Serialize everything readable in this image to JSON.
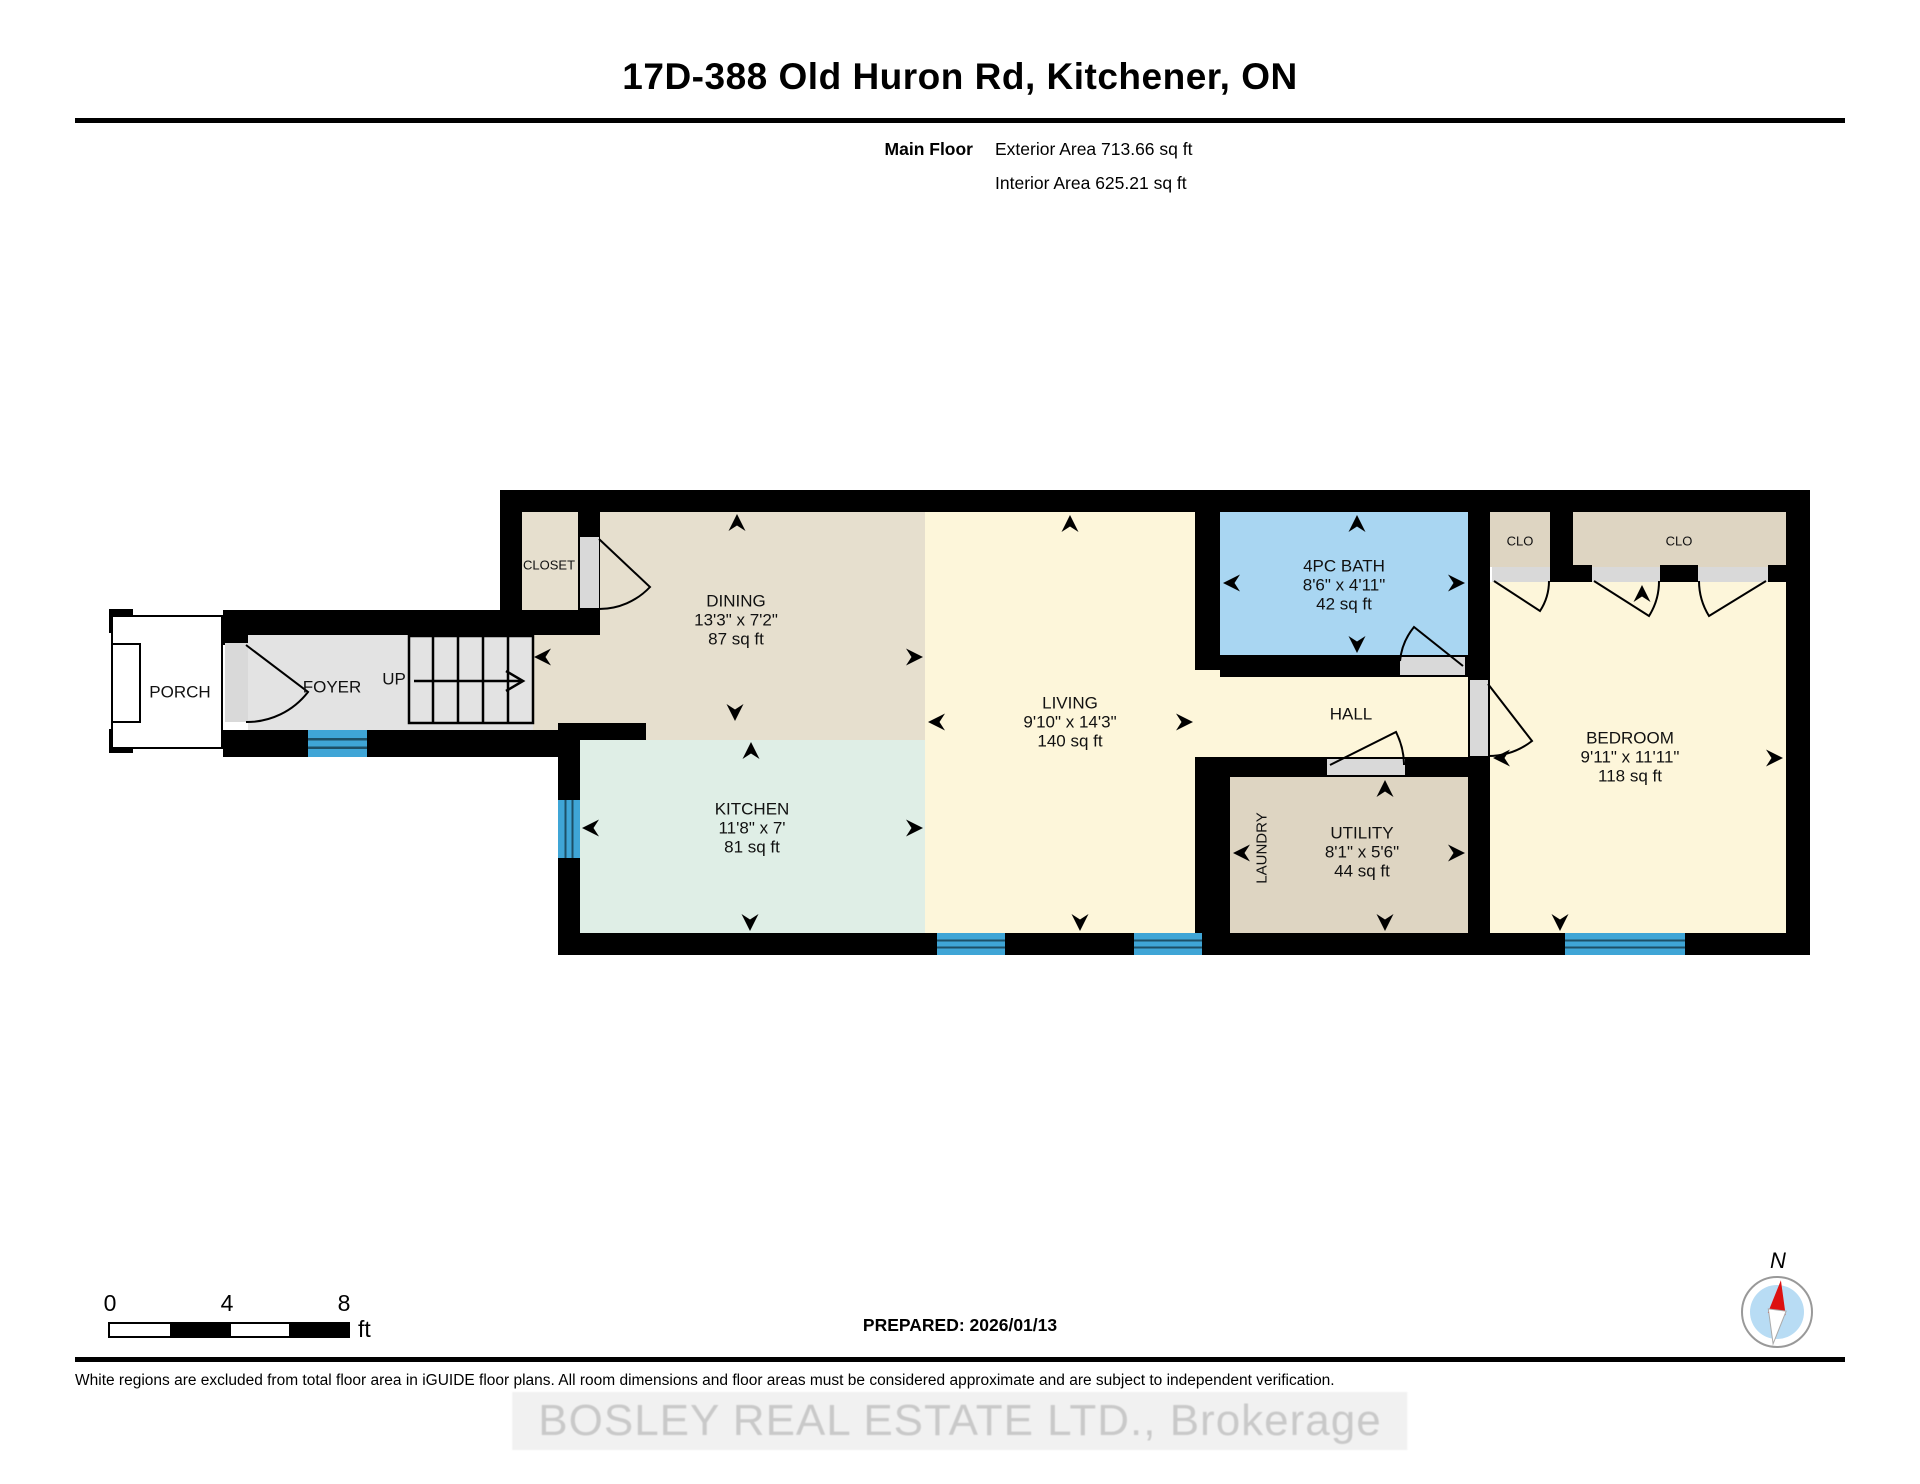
{
  "header": {
    "title": "17D-388 Old Huron Rd, Kitchener, ON",
    "floor_label": "Main Floor",
    "exterior_area": "Exterior Area 713.66 sq ft",
    "interior_area": "Interior Area 625.21 sq ft"
  },
  "rooms": {
    "porch": {
      "name": "PORCH"
    },
    "foyer": {
      "name": "FOYER"
    },
    "stairs": {
      "direction_label": "UP"
    },
    "closet": {
      "name": "CLOSET"
    },
    "dining": {
      "name": "DINING",
      "dims": "13'3\" x 7'2\"",
      "area": "87 sq ft"
    },
    "kitchen": {
      "name": "KITCHEN",
      "dims": "11'8\" x 7'",
      "area": "81 sq ft"
    },
    "living": {
      "name": "LIVING",
      "dims": "9'10\" x 14'3\"",
      "area": "140 sq ft"
    },
    "bath": {
      "name": "4PC BATH",
      "dims": "8'6\" x 4'11\"",
      "area": "42 sq ft"
    },
    "hall": {
      "name": "HALL"
    },
    "laundry": {
      "name": "LAUNDRY"
    },
    "utility": {
      "name": "UTILITY",
      "dims": "8'1\" x 5'6\"",
      "area": "44 sq ft"
    },
    "bedroom": {
      "name": "BEDROOM",
      "dims": "9'11\" x 11'11\"",
      "area": "118 sq ft"
    },
    "clo_small": {
      "name": "CLO"
    },
    "clo_large": {
      "name": "CLO"
    }
  },
  "scale": {
    "ticks": [
      "0",
      "4",
      "8"
    ],
    "unit": "ft"
  },
  "compass": {
    "north_label": "N"
  },
  "footer": {
    "prepared": "PREPARED: 2026/01/13",
    "disclaimer": "White regions are excluded from total floor area in iGUIDE floor plans. All room dimensions and floor areas must be considered approximate and are subject to independent verification.",
    "watermark": "BOSLEY REAL ESTATE LTD., Brokerage"
  },
  "colors": {
    "wall": "#000000",
    "floor_tan": "#e6dfce",
    "floor_tan_dark": "#ded5c2",
    "floor_mint": "#dfeee6",
    "floor_yellow": "#fdf6da",
    "floor_blue": "#a9d6f2",
    "floor_gray": "#e3e3e3",
    "window_blue": "#3fa5d6",
    "compass_red": "#dd1111",
    "compass_blue": "#b8dcf4"
  }
}
